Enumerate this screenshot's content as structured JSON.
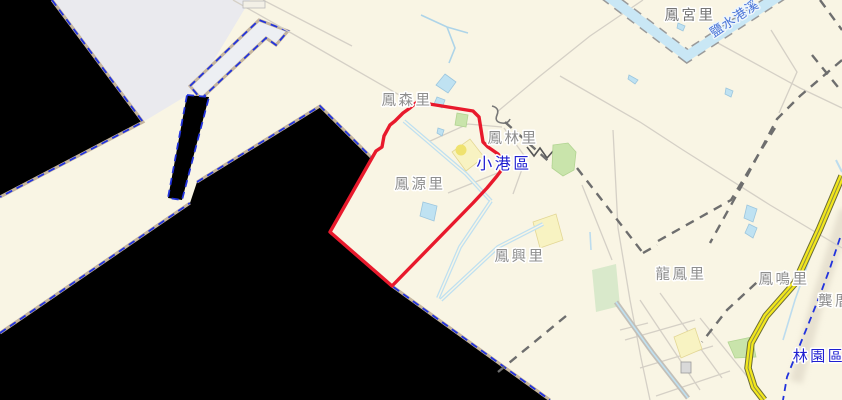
{
  "map": {
    "labels": {
      "fenggong_li": "鳳宮里",
      "yanshuigang_creek": "鹽水港溪",
      "fengsen_li": "鳳森里",
      "fenglin_li": "鳳林里",
      "xiaogang_district": "小港區",
      "fengyuan_li": "鳳源里",
      "fengxing_li": "鳳興里",
      "longfeng_li": "龍鳳里",
      "fengming_li": "鳳鳴里",
      "gongcuo": "龔厝",
      "linyuan_district": "林園區"
    },
    "colors": {
      "background": "#f9f5e4",
      "sea_gray": "#eaeaee",
      "landfill_black": "#000000",
      "coast_dash_blue": "#2233dd",
      "coast_underlay_tan": "#c4b49e",
      "highlight_boundary_red": "#e8192c",
      "river_fill": "#c9e7f5",
      "district_label_blue": "#1f1fd0",
      "village_label_gray": "#8e8e8e",
      "highway_yellow": "#f2e71d"
    }
  }
}
